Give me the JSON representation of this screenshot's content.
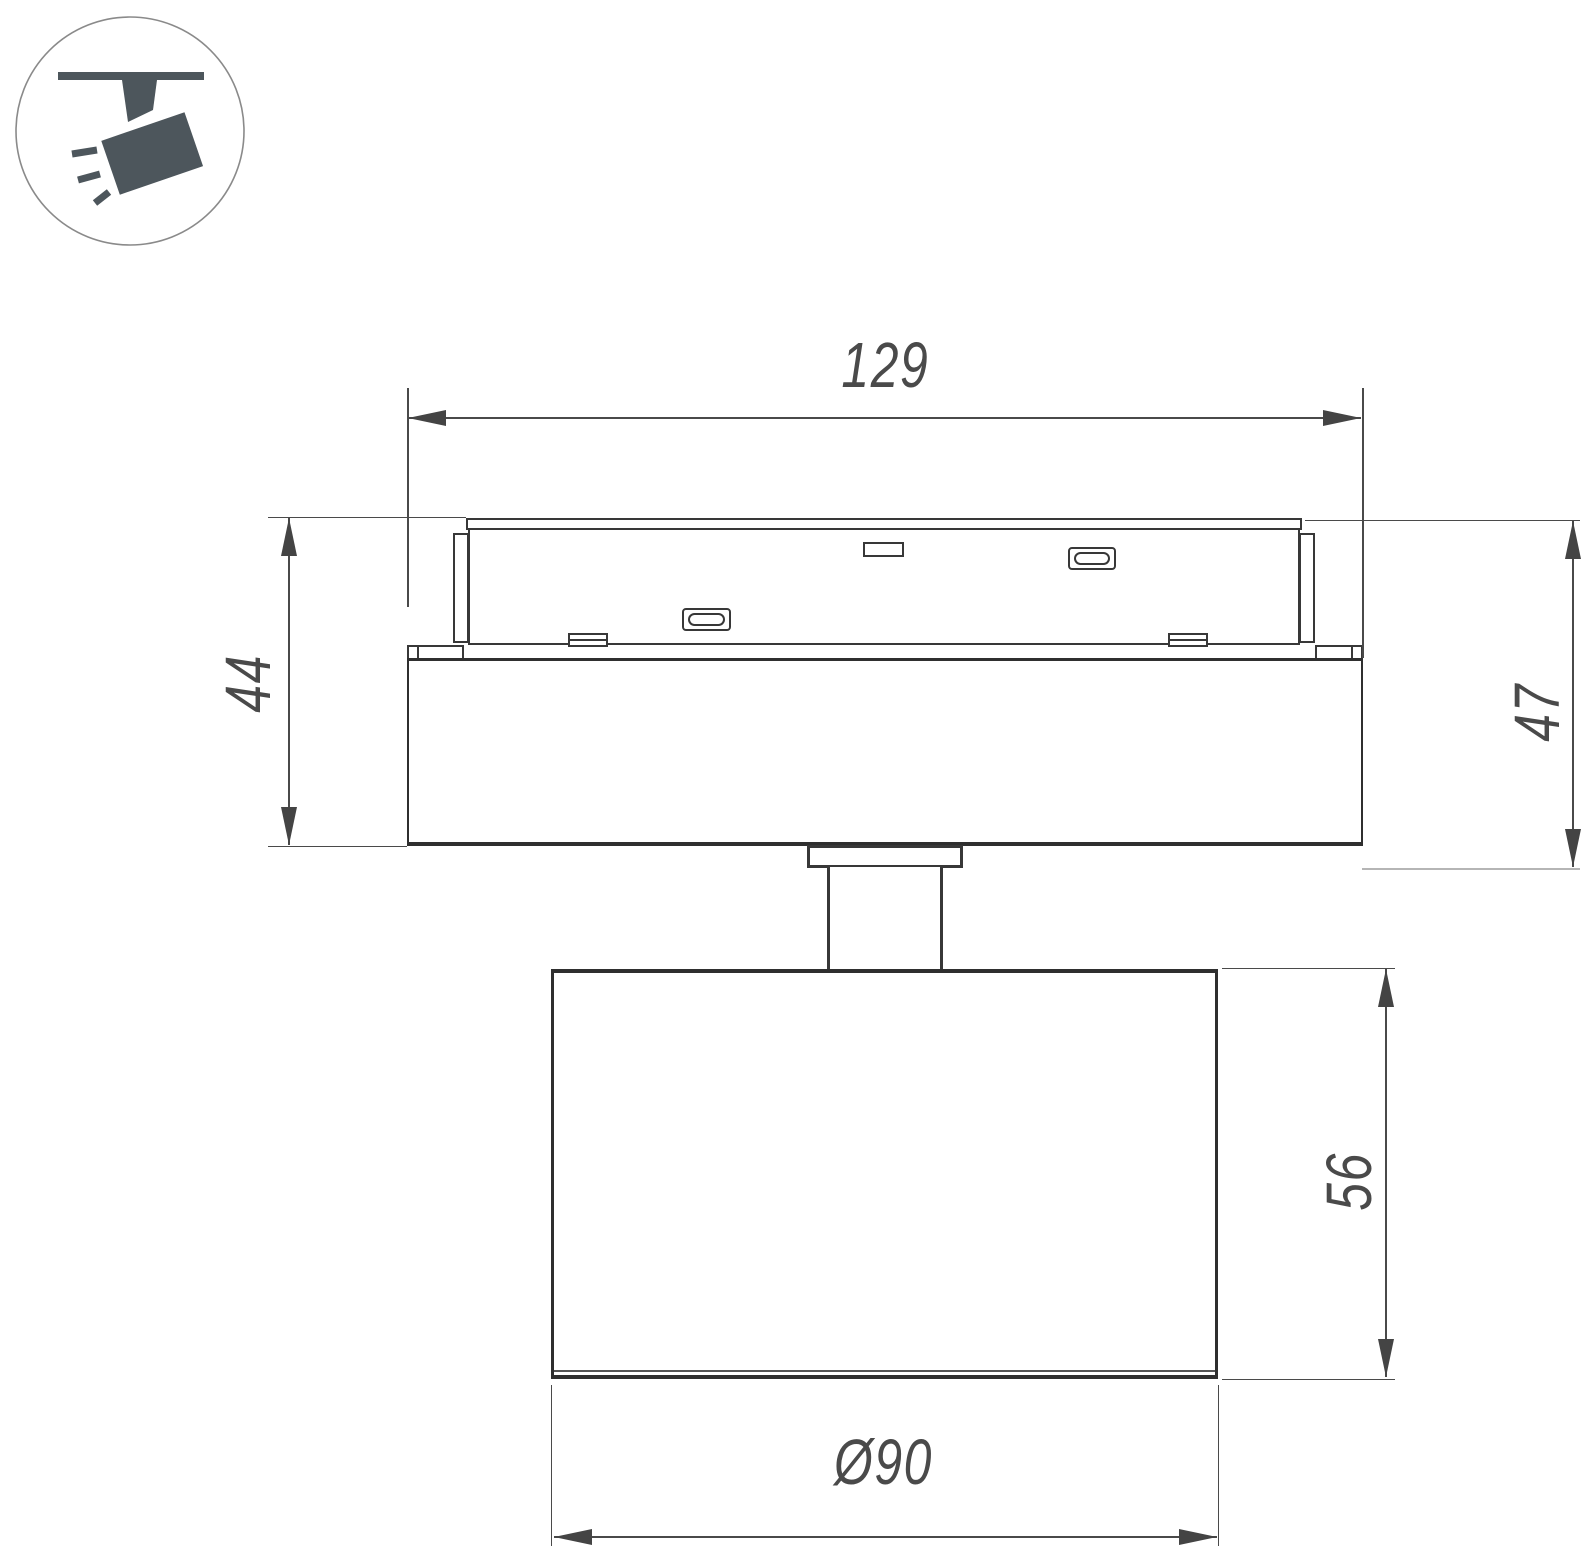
{
  "drawing": {
    "title": "track-spotlight-dimension-drawing",
    "dims": {
      "width": "129",
      "left_height": "44",
      "right_height": "47",
      "body_height": "56",
      "diameter": "Ø90"
    },
    "icon": {
      "name": "track-spotlight-icon",
      "circle_stroke": "#8a8a8a",
      "shape_fill": "#4d565c"
    },
    "colors": {
      "line": "#383838",
      "heavy_line": "#2f2f2f",
      "dim_line": "#4a4a4a",
      "light_extension": "#b5b5b5",
      "text": "#4a4a4a",
      "background": "#ffffff"
    }
  }
}
